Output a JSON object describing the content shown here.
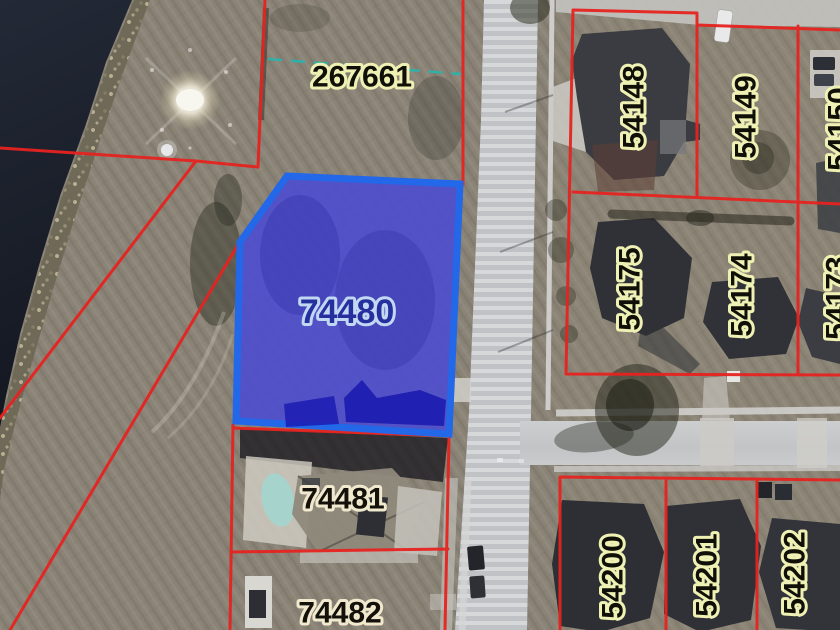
{
  "map": {
    "kind": "aerial parcel map",
    "selected_parcel": "74480",
    "parcels": [
      {
        "number": "267661"
      },
      {
        "number": "74480"
      },
      {
        "number": "74481"
      },
      {
        "number": "74482"
      },
      {
        "number": "54148"
      },
      {
        "number": "54149"
      },
      {
        "number": "54150"
      },
      {
        "number": "54175"
      },
      {
        "number": "54174"
      },
      {
        "number": "54173"
      },
      {
        "number": "54200"
      },
      {
        "number": "54201"
      },
      {
        "number": "54202"
      }
    ],
    "colors": {
      "parcel_boundary": "#e62320",
      "selected_fill": "#4c4ccf",
      "selected_border": "#2368e8",
      "survey_dash_line": "#2fb0a8",
      "label_halo_yellow": "#eff0b4",
      "label_halo_cream": "#f0e9cd",
      "label_halo_blue": "#c2d8f2"
    }
  }
}
